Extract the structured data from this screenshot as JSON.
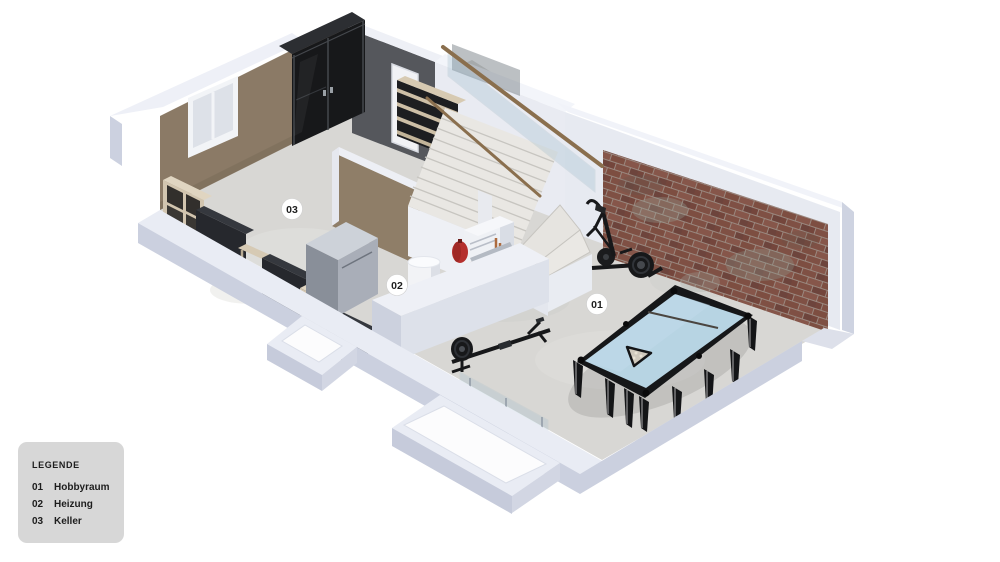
{
  "legend": {
    "title": "LEGENDE",
    "items": [
      {
        "code": "01",
        "label": "Hobbyraum"
      },
      {
        "code": "02",
        "label": "Heizung"
      },
      {
        "code": "03",
        "label": "Keller"
      }
    ]
  },
  "plan": {
    "labels": [
      {
        "id": "01",
        "room": "Hobbyraum"
      },
      {
        "id": "02",
        "room": "Heizung"
      },
      {
        "id": "03",
        "room": "Keller"
      }
    ]
  },
  "colors": {
    "background": "#ffffff",
    "wall_top": "#e9ecf4",
    "wall_side": "#cbd0df",
    "wall_interior_white": "#e9ebf2",
    "floor": "#d8d7d4",
    "brown_wall": "#8b7a66",
    "dark_wall": "#55575c",
    "closet_black": "#17181a",
    "brick": "#7d4e41",
    "wood_shelf": "#d2c5af",
    "handrail_wood": "#8a6f4e",
    "pool_felt": "#b7d4e3",
    "equipment_black": "#17181a",
    "heater_red": "#b5302e",
    "copper_pipe": "#ad6b3e",
    "legend_bg": "#d7d7d7",
    "label_bg": "#ffffff"
  }
}
